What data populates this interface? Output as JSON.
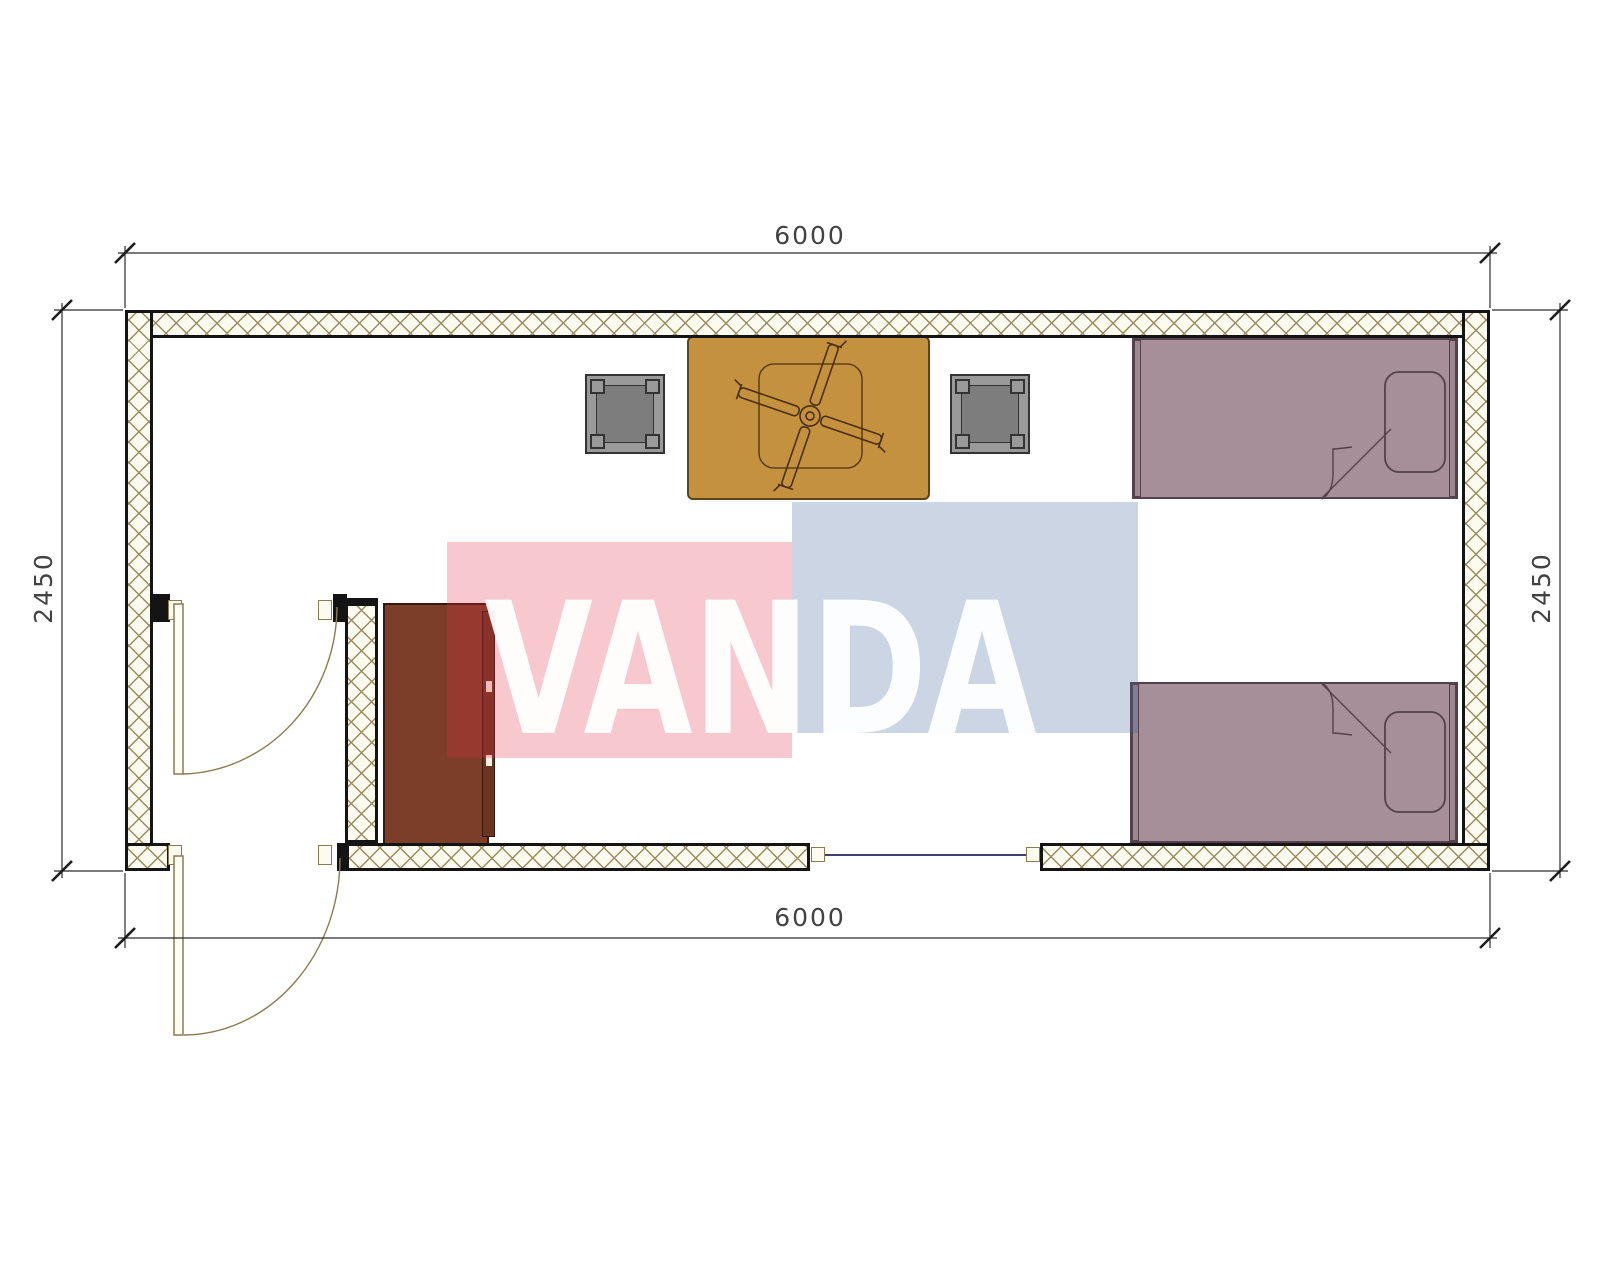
{
  "drawing": {
    "title_watermark": {
      "text": "VANDA"
    },
    "dimensions": {
      "top": "6000",
      "bottom": "6000",
      "left": "2450",
      "right": "2450"
    },
    "colors": {
      "line_black": "#141414",
      "wall_bg": "#fdfaf0",
      "hatch_line": "#9c8b5e",
      "door_tan": "#8d7b4e",
      "window_glass": "#3f3f75",
      "table_fill": "#c4913f",
      "table_stroke": "#5c4416",
      "fan_stroke": "#4a3010",
      "stool_frame": "#9a9a9a",
      "stool_seat": "#7d7d7d",
      "stool_stroke": "#333333",
      "bed_fill": "#a78f9a",
      "bed_endbar": "#9d8791",
      "bed_stroke": "#54414b",
      "cabinet_fill": "#7c3e28",
      "cabinet_front": "#6b3420",
      "cabinet_stroke": "#35190e",
      "watermark_red": "rgba(229,42,68,0.26)",
      "watermark_blue": "rgba(62,98,156,0.27)",
      "watermark_text": "rgba(255,255,255,0.94)",
      "dim_text": "#2e2e2e",
      "dim_line": "#2b2b2b"
    }
  }
}
